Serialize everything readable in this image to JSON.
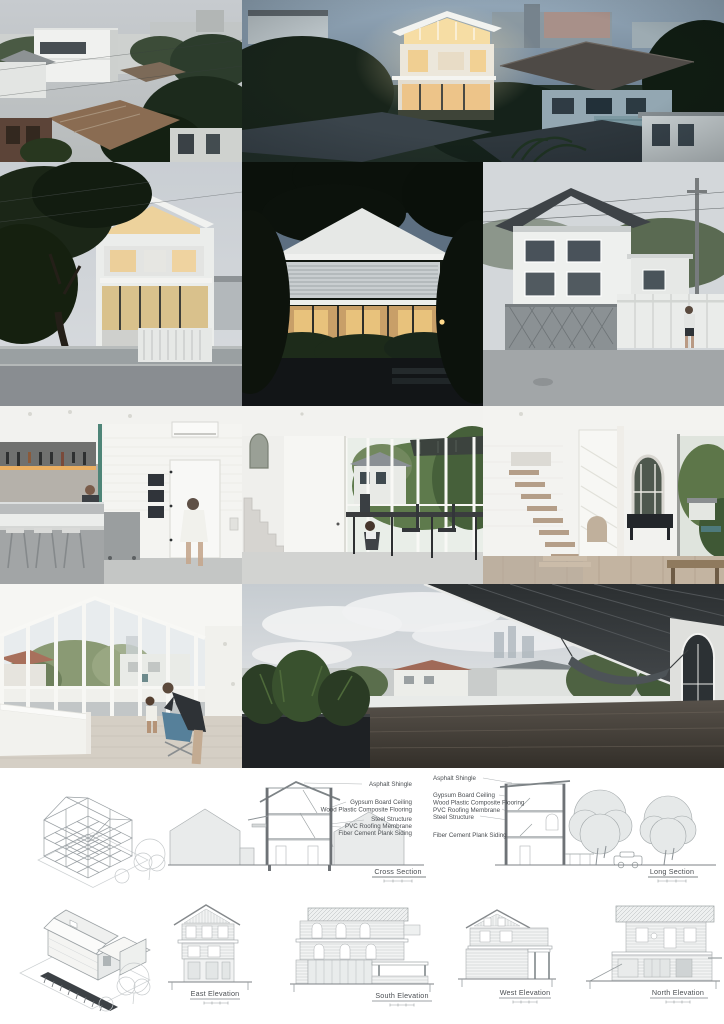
{
  "page": {
    "width": 724,
    "height": 1024,
    "background": "#ffffff"
  },
  "photos": [
    {
      "name": "photo-aerial-day",
      "scene": "daytime rooftop view of dense neighborhood with white three-storey house"
    },
    {
      "name": "photo-aerial-dusk",
      "scene": "dusk rooftop view of glowing white gabled house among trees and neighbor roofs"
    },
    {
      "name": "photo-street-corner-dusk",
      "scene": "dusk street view of white house behind large tree and concrete fence"
    },
    {
      "name": "photo-front-facade-dusk",
      "scene": "dusk front view of white house with louvred band and lit glass lounge"
    },
    {
      "name": "photo-street-day",
      "scene": "daytime street view with white house, folding gate, white fence and passerby"
    },
    {
      "name": "photo-kitchen",
      "scene": "white kitchen with hanging rack, island counter, stools and child running"
    },
    {
      "name": "photo-dining",
      "scene": "dining space with concrete stair, long dark table and garden glazing"
    },
    {
      "name": "photo-staircase",
      "scene": "white staircase hall with arched windows, black console and timber floor"
    },
    {
      "name": "photo-attic-living",
      "scene": "top floor room with gabled ceiling, glazed gable wall, family and butterfly chair"
    },
    {
      "name": "photo-roof-terrace",
      "scene": "roof terrace under dark soffit with planter, deck, hammock and city view"
    }
  ],
  "drawings": {
    "structure_axon": {
      "name": "structural-frame-axonometric"
    },
    "house_axon": {
      "name": "house-axonometric"
    },
    "cross_section": {
      "caption": "Cross Section",
      "materials": [
        "Asphalt Shingle",
        "Gypsum Board Ceiling",
        "Wood Plastic Composite Flooring",
        "Steel Structure",
        "PVC Roofing Membrane",
        "Fiber Cement Plank Siding"
      ]
    },
    "long_section": {
      "caption": "Long Section",
      "materials": [
        "Asphalt Shingle",
        "Gypsum Board Ceiling",
        "Wood Plastic Composite Flooring",
        "PVC Roofing Membrane",
        "Steel Structure",
        "Fiber Cement Plank Siding"
      ]
    },
    "elevations": [
      {
        "caption": "East Elevation"
      },
      {
        "caption": "South Elevation"
      },
      {
        "caption": "West Elevation"
      },
      {
        "caption": "North Elevation"
      }
    ]
  },
  "colors": {
    "drawing_line": "#8c9296",
    "drawing_fill": "#e9ebeb",
    "label_text": "#4b4f53"
  }
}
